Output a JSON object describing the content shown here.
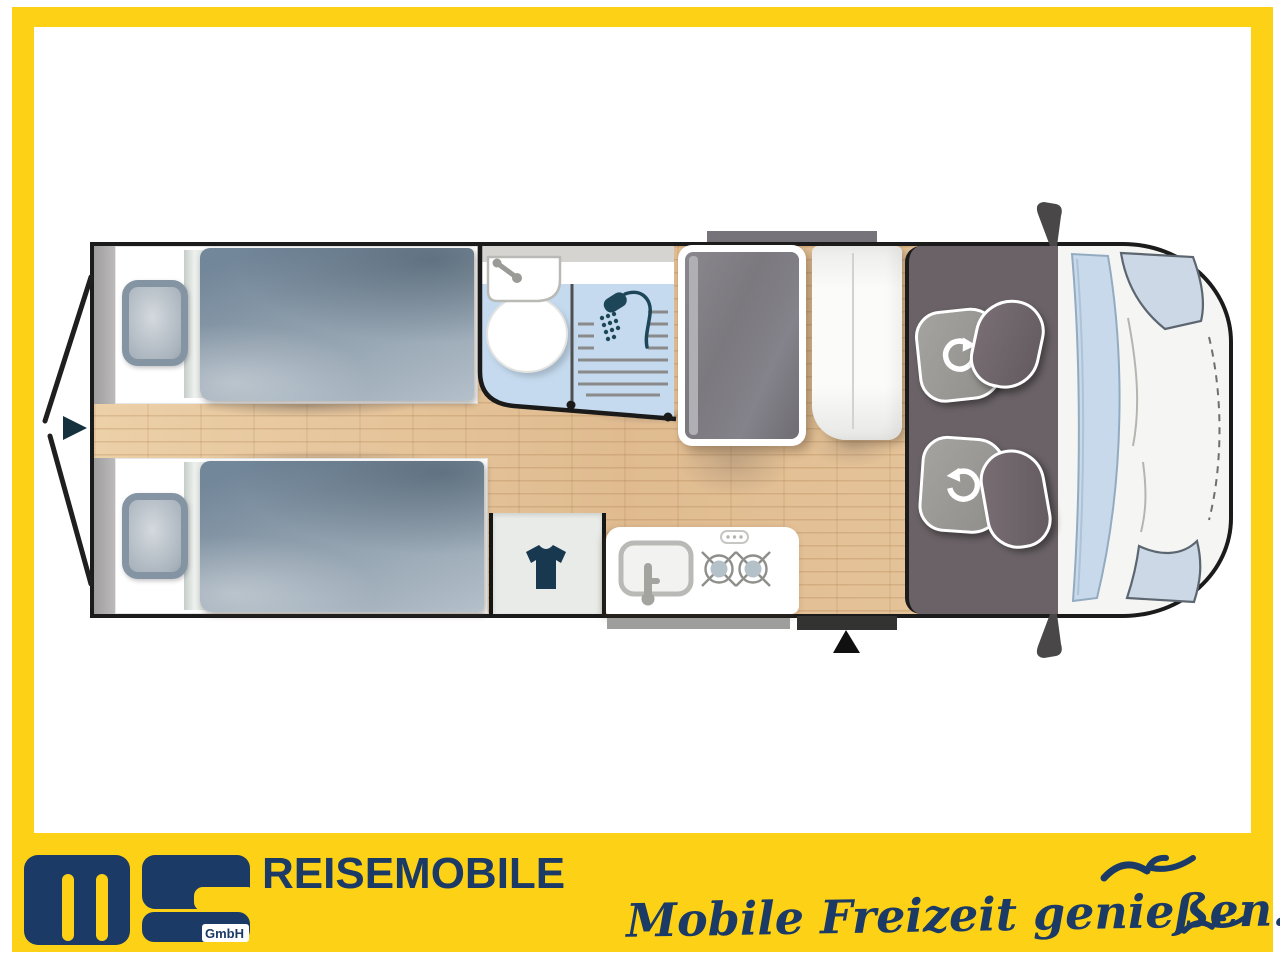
{
  "page": {
    "background": "#ffffff",
    "frame_color": "#fcd116"
  },
  "brand": {
    "logo_text": "ms",
    "logo_suffix": "GmbH",
    "company_line": "REISEMOBILE",
    "slogan": "Mobile Freizeit genießen."
  },
  "colors": {
    "yellow": "#fcd116",
    "navy": "#1b3a66",
    "outline_black": "#1b1b1b",
    "wood_floor": "#e6c69c",
    "duvet_gray_blue": "#8496a6",
    "pillow_gray": "#8494a3",
    "bathroom_blue": "#c5daee",
    "wardrobe_dark": "#7e7c81",
    "cab_floor": "#6a6266",
    "seat_base_gray": "#9a9995",
    "seat_back_taupe": "#6f666b",
    "icon_teal": "#1c4456",
    "windshield_blue": "#c7d9ea"
  },
  "floorplan": {
    "view": "camper-van-top-view",
    "rooms": [
      {
        "name": "single-bed-rear-top"
      },
      {
        "name": "single-bed-rear-bottom"
      },
      {
        "name": "washroom",
        "fixtures": [
          "wash-basin",
          "toilet",
          "shower"
        ]
      },
      {
        "name": "wardrobe-cabinet"
      },
      {
        "name": "tall-cabinet"
      },
      {
        "name": "clothes-closet"
      },
      {
        "name": "kitchen-block",
        "fixtures": [
          "sink",
          "two-burner-hob"
        ]
      },
      {
        "name": "driver-cab",
        "fixtures": [
          "swivel-seat-top",
          "swivel-seat-bottom"
        ]
      },
      {
        "name": "vehicle-front-cab"
      }
    ],
    "icons": [
      "rear-exit-arrow-icon",
      "rear-door-open-lines",
      "faucet-icon",
      "shower-head-icon",
      "tshirt-icon",
      "hob-burner-icon",
      "seat-rotation-icon",
      "entry-arrow-icon",
      "seagull-icon-large",
      "seagull-icon-small"
    ]
  }
}
